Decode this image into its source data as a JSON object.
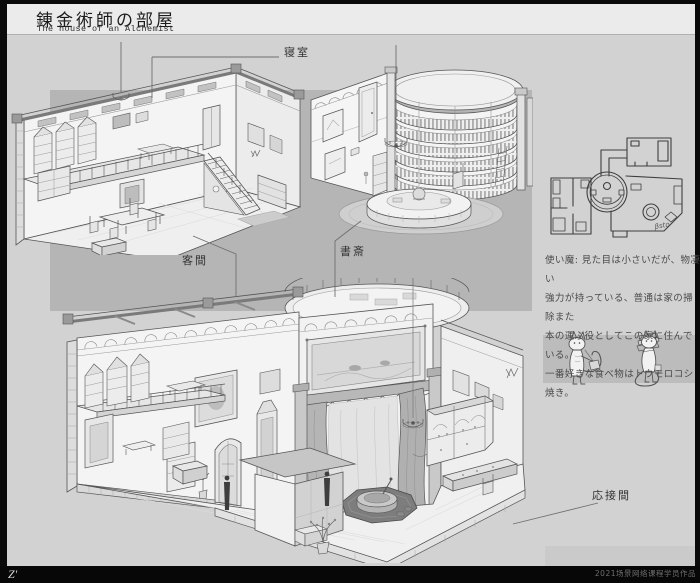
{
  "page": {
    "title_jp": "錬金術師の部屋",
    "title_en": "The house of an Alchemist",
    "footer_mark": "Z'",
    "footer_credit": "2021场景网络课程学员作品"
  },
  "labels": {
    "bedroom": "寝室",
    "guest_room": "客間",
    "study": "書斎",
    "reception_room": "応接間"
  },
  "description": {
    "lines": [
      "使い魔: 見た目は小さいだが、物凄い",
      "強力が持っている、普通は家の掃除また",
      "本の運ぶ役としてこの家に住んでいる。",
      "一番好きな食べ物はトウモロコシ焼き。"
    ]
  },
  "plan": {
    "signature": "βsto"
  },
  "colors": {
    "background": "#d2d2d2",
    "panel": "#b5b5b5",
    "title_band": "#ebebeb",
    "frame": "#0a0a0a",
    "ink": "#4a4a4a"
  }
}
